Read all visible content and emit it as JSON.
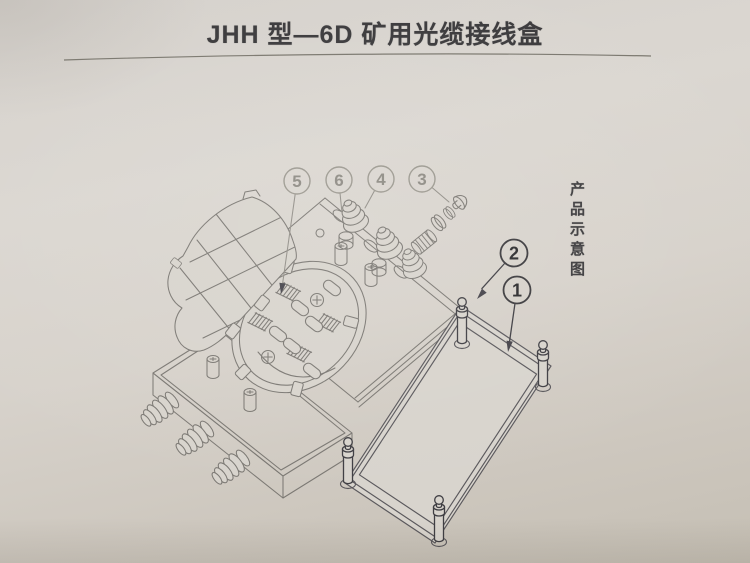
{
  "page": {
    "title": "JHH 型—6D 矿用光缆接线盒",
    "side_caption": "产品示意图"
  },
  "diagram": {
    "description_visible_parts": "exploded line drawing of junction box",
    "callouts": {
      "c1": "1",
      "c2": "2",
      "c3": "3",
      "c4": "4",
      "c5": "5",
      "c6": "6"
    }
  },
  "colors": {
    "paper_top": "#dbd7d1",
    "paper_bottom": "#c5bfb4",
    "title_ink": "#3a393b",
    "line_medium": "#7b7873",
    "line_faint": "#918e87",
    "line_dark": "#3f3e43"
  }
}
